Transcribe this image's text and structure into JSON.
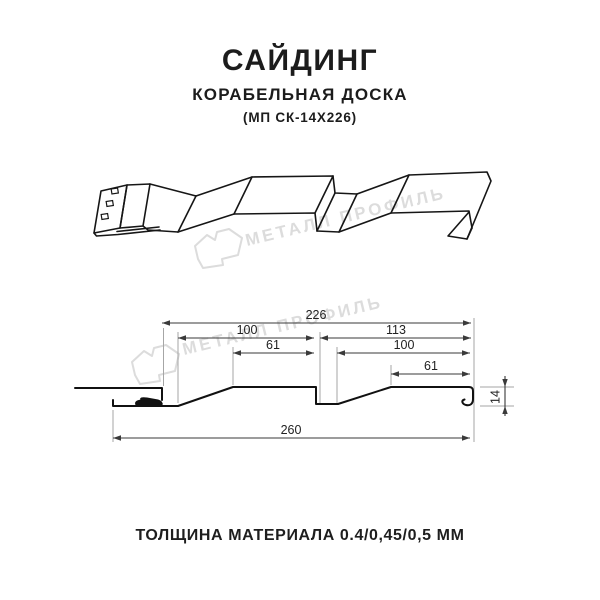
{
  "header": {
    "title": "САЙДИНГ",
    "subtitle": "КОРАБЕЛЬНАЯ ДОСКА",
    "model": "(МП СК-14Х226)"
  },
  "watermark": {
    "brand": "МЕТАЛЛ ПРОФИЛЬ",
    "color": "#dcdcdc"
  },
  "diagram": {
    "type": "technical-drawing",
    "product": "metal siding profile, ship-lap board",
    "dimensions_mm": {
      "overall_width": 260,
      "working_width": 226,
      "left_module_total": 100,
      "left_module_face": 61,
      "right_module_total": 113,
      "right_module_pitch": 100,
      "right_module_face": 61,
      "profile_height": 14
    },
    "labels": {
      "d226": "226",
      "d100_left": "100",
      "d113": "113",
      "d61_left": "61",
      "d100_right": "100",
      "d61_right": "61",
      "d260": "260",
      "d14": "14"
    }
  },
  "footer": {
    "thickness_label": "ТОЛЩИНА МАТЕРИАЛА 0.4/0,45/0,5 ММ"
  },
  "colors": {
    "background": "#ffffff",
    "line": "#161616",
    "dimension_line": "#3a3a3a",
    "extension_line": "#a6a6a6",
    "watermark": "#dcdcdc",
    "text": "#1e1e1e"
  }
}
